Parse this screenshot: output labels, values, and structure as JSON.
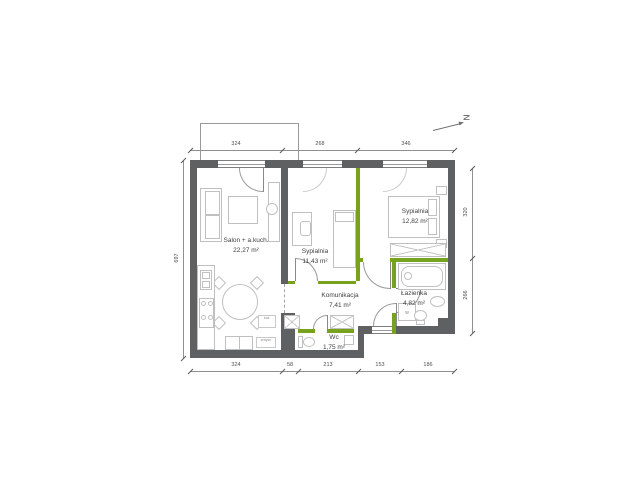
{
  "plan": {
    "north_label": "N",
    "rooms": [
      {
        "name": "Salon + a.kuch.",
        "area": "22,27 m²"
      },
      {
        "name": "Sypialnia",
        "area": "11,43 m²"
      },
      {
        "name": "Sypialnia",
        "area": "12,82 m²"
      },
      {
        "name": "Komunikacja",
        "area": "7,41 m²"
      },
      {
        "name": "Łazienka",
        "area": "4,82 m²"
      },
      {
        "name": "Wc",
        "area": "1,75 m²"
      }
    ],
    "dimensions": {
      "top": [
        "324",
        "268",
        "346"
      ],
      "bottom": [
        "324",
        "58",
        "213",
        "153",
        "186"
      ],
      "left": [
        "697"
      ],
      "right": [
        "320",
        "266"
      ]
    },
    "appliances": {
      "washer": "w",
      "fridge": "lod.",
      "dishwasher": "zmyw."
    },
    "colors": {
      "wall": "#5e6062",
      "accent_green": "#76a21e"
    }
  }
}
